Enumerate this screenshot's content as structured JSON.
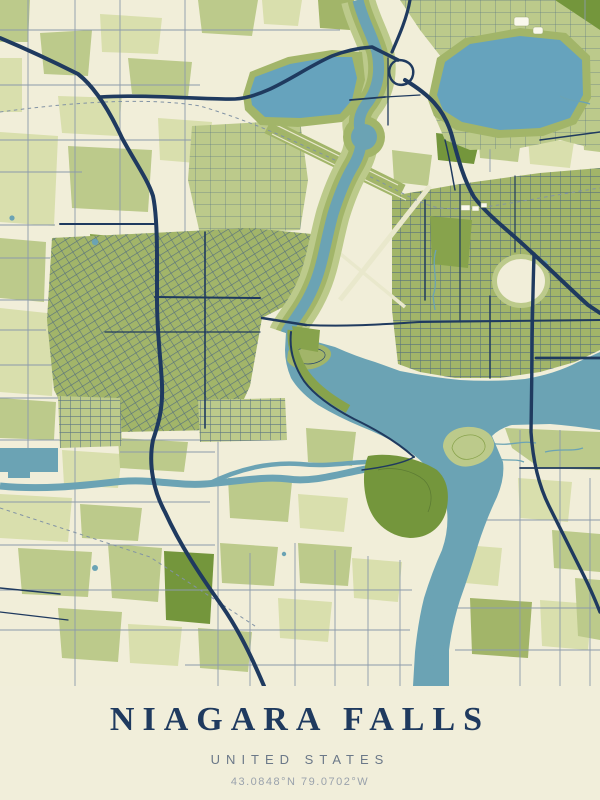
{
  "poster": {
    "title": "NIAGARA FALLS",
    "subtitle": "UNITED STATES",
    "coordinates": "43.0848°N 79.0702°W"
  },
  "map": {
    "style": "minimal poster map, no labels",
    "palette": {
      "bg": "#f1eed9",
      "footer_bg": "#f1eeda",
      "g1": "#d9dfad",
      "g2": "#bcca8b",
      "g3": "#a2b569",
      "g4": "#87a34c",
      "g5": "#74963c",
      "water": "#6ba3b4",
      "water_res": "#66a3bd",
      "road_major": "#1f3a5f",
      "road_minor": "#8b9aab",
      "road_urban": "#4a6581",
      "rail": "#8293a5",
      "pale": "#e9e8cc",
      "title": "#1f3a5f",
      "subtitle": "#6b7888",
      "coords": "#9aa2ac"
    }
  }
}
